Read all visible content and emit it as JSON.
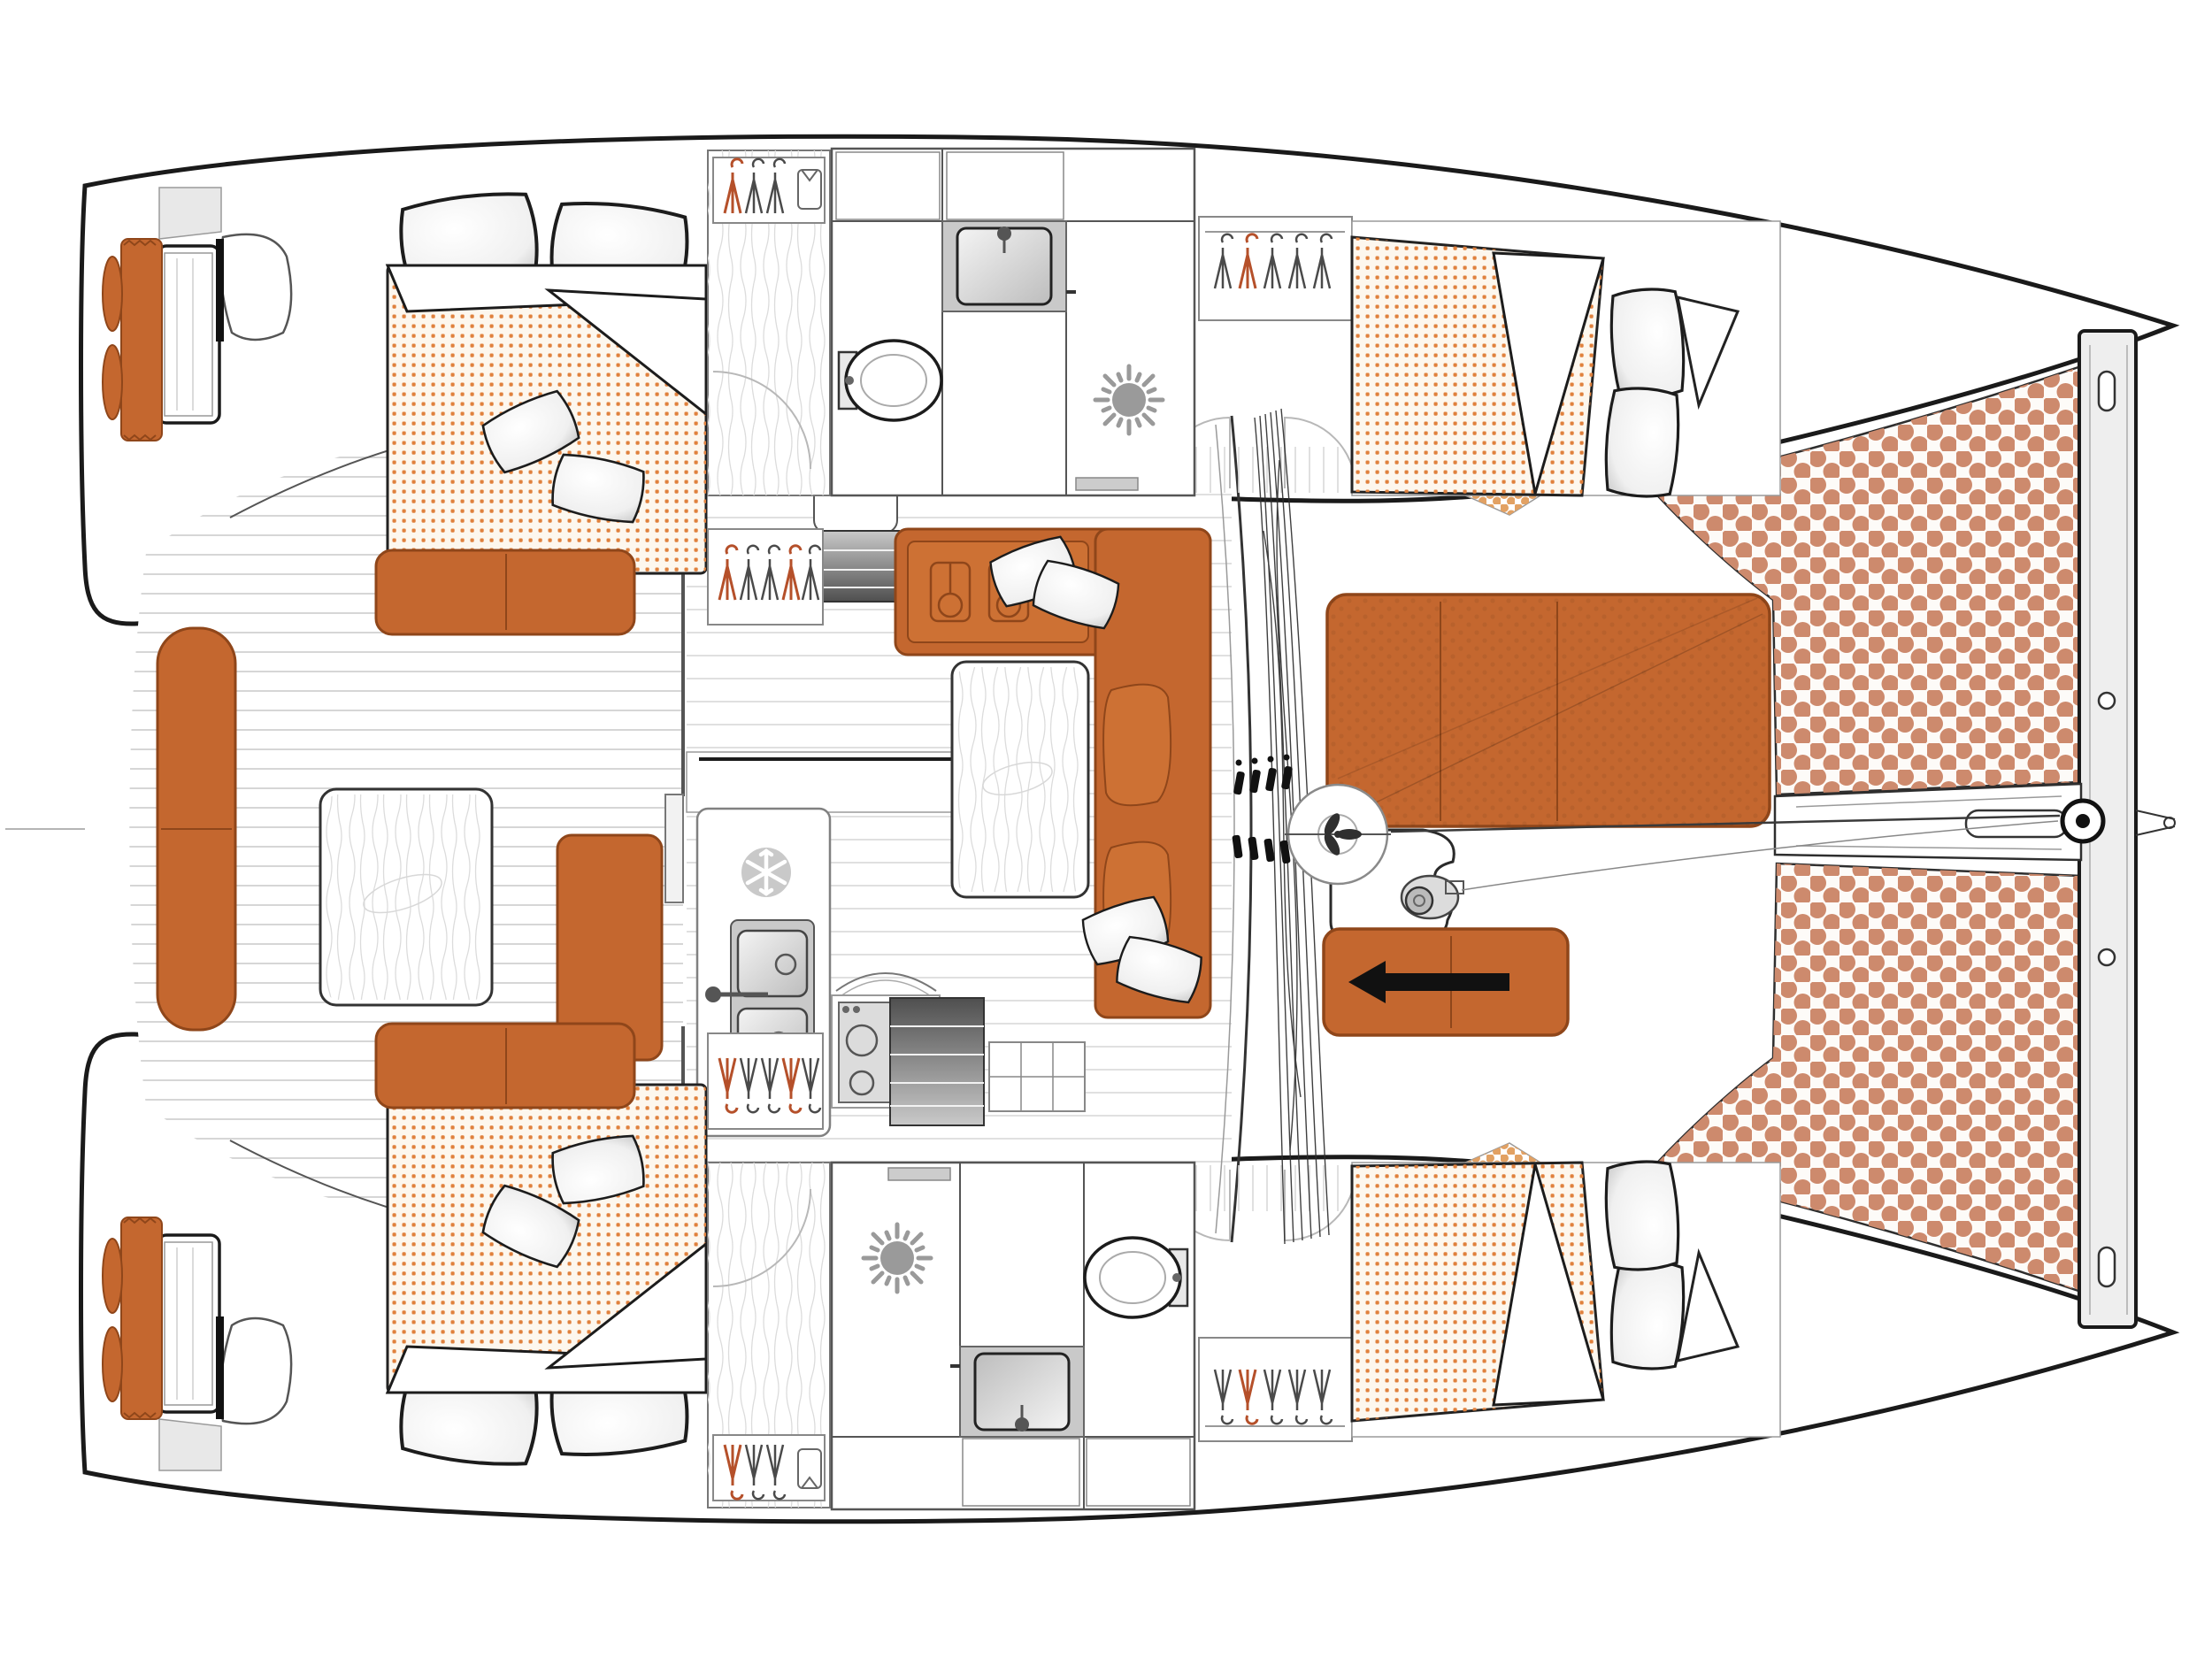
{
  "diagram": {
    "type": "floor-plan",
    "subject": "catamaran sailing yacht deck and interior layout, top view, bow to the right",
    "orientation": {
      "bow": "right",
      "stern": "left",
      "port_hull": "top",
      "starboard_hull": "bottom"
    },
    "colors": {
      "background": "#ffffff",
      "outline": "#1a1a1a",
      "wall": "#555555",
      "thin_line": "#9a9a9a",
      "plank_line": "#d6d6d6",
      "upholstery": "#c4672f",
      "upholstery_seam": "#8f461a",
      "upholstery_alt": "#cd7134",
      "mattress_base": "#fdf7ee",
      "mattress_dot": "#e0813d",
      "trampoline_base": "#fdfbf8",
      "trampoline_dot": "#cd8a6d",
      "trampoline_dot_small": "#e2a163",
      "fixture_gray": "#c9c9c9",
      "fixture_light": "#e8e8e8",
      "steps_dark": "#4f4f4f",
      "black_detail": "#111111"
    },
    "regions": [
      "port-aft-cabin",
      "port-bathroom",
      "port-forward-cabin",
      "starboard-aft-cabin",
      "starboard-bathroom",
      "starboard-forward-cabin",
      "salon",
      "galley",
      "cockpit",
      "aft-platform-port",
      "aft-platform-starboard",
      "foredeck-lounge",
      "trampoline",
      "mast-station",
      "bow-crossbeam",
      "bowsprit"
    ],
    "icons": [
      "hanger-icon",
      "shirt-icon",
      "toilet-icon",
      "washbasin-icon",
      "shower-sunburst-icon",
      "snowflake-fridge-icon",
      "double-sink-icon",
      "stove-burners-icon",
      "mast-icon",
      "windlass-icon",
      "arrow-left-icon",
      "pillow-icon",
      "chainplate-ring-icon"
    ],
    "furniture": {
      "double_berths": 4,
      "bathrooms": 2,
      "cockpit_tables": 1,
      "salon_tables": 1,
      "sunbeds": 1,
      "trampoline_panels": 2
    }
  }
}
